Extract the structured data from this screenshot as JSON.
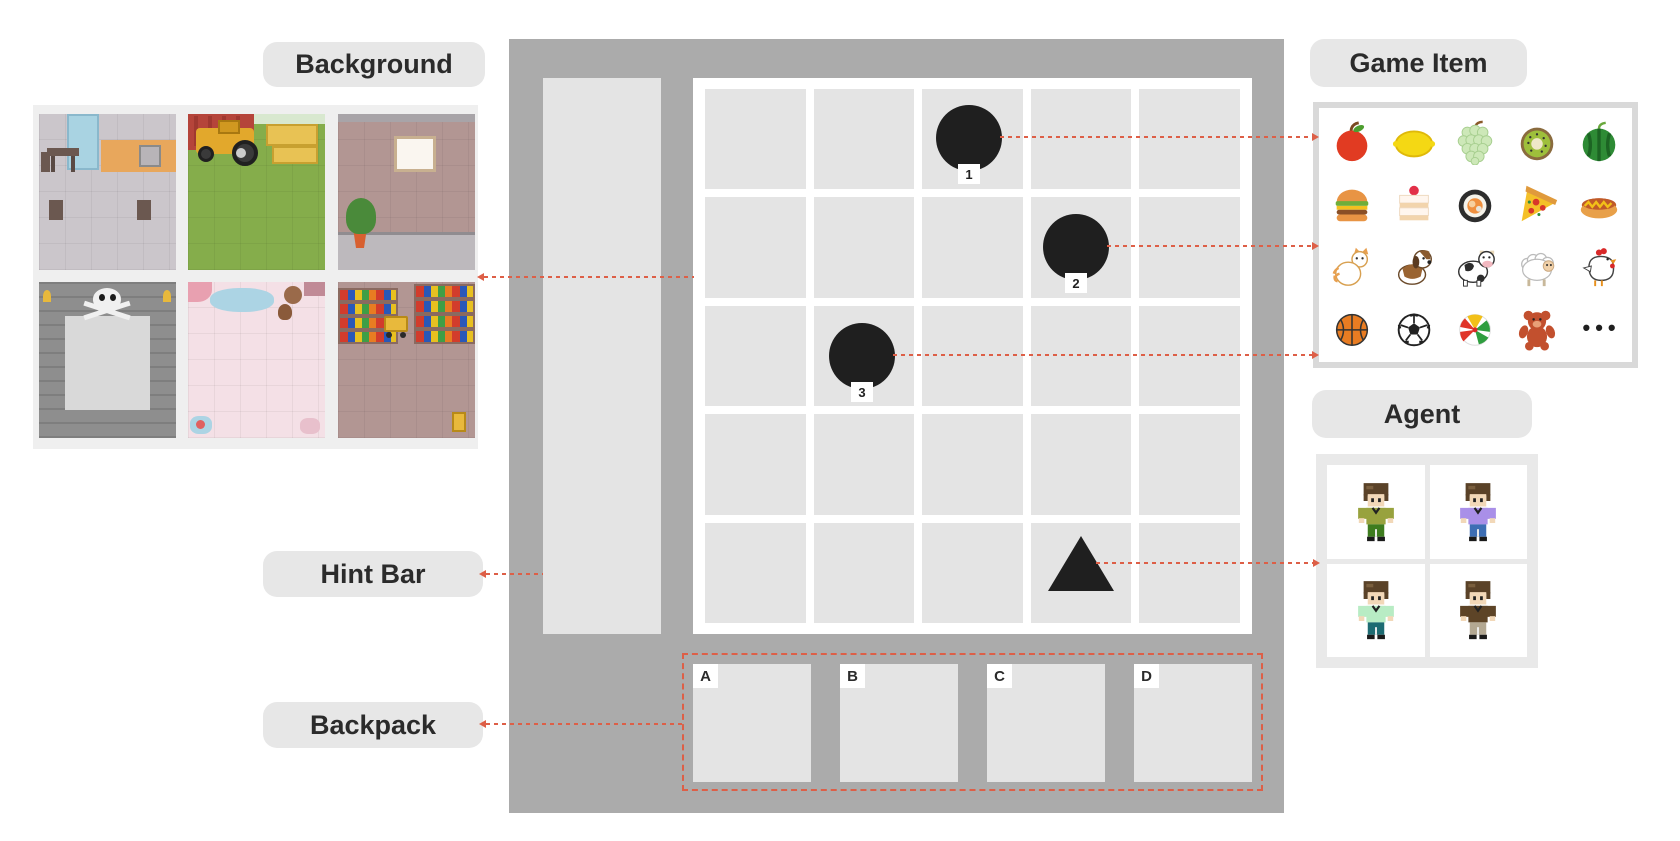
{
  "labels": {
    "background": "Background",
    "game_item": "Game Item",
    "agent": "Agent",
    "hint_bar": "Hint Bar",
    "backpack": "Backpack"
  },
  "background_thumbnails": [
    {
      "name": "kitchen-dining-room"
    },
    {
      "name": "farm-with-tractor"
    },
    {
      "name": "room-wall-with-plant"
    },
    {
      "name": "dungeon-with-skull"
    },
    {
      "name": "pink-playroom"
    },
    {
      "name": "supermarket-shelves"
    }
  ],
  "board": {
    "rows": 5,
    "cols": 5,
    "markers": [
      {
        "label": "1",
        "shape": "circle",
        "row": 1,
        "col": 3
      },
      {
        "label": "2",
        "shape": "circle",
        "row": 2,
        "col": 4
      },
      {
        "label": "3",
        "shape": "circle",
        "row": 3,
        "col": 2
      },
      {
        "label": "",
        "shape": "triangle",
        "row": 5,
        "col": 4
      }
    ]
  },
  "backpack": {
    "slots": [
      "A",
      "B",
      "C",
      "D"
    ]
  },
  "game_items": [
    "apple",
    "lemon",
    "grapes",
    "kiwi",
    "watermelon",
    "hamburger",
    "cake",
    "sushi",
    "pizza",
    "hot-dog",
    "cat",
    "dog",
    "cow",
    "sheep",
    "chicken",
    "basketball",
    "soccer-ball",
    "beach-ball",
    "teddy-bear"
  ],
  "game_items_more": "•••",
  "agents": [
    "boy-green-shirt",
    "boy-purple-shirt",
    "boy-mint-shirt",
    "boy-brown-shirt"
  ],
  "colors": {
    "panel_gray": "#ababab",
    "cell_gray": "#e4e4e4",
    "pill_gray": "#e7e7e7",
    "marker_black": "#1f1f1f",
    "connector_red": "#dd5f47"
  }
}
